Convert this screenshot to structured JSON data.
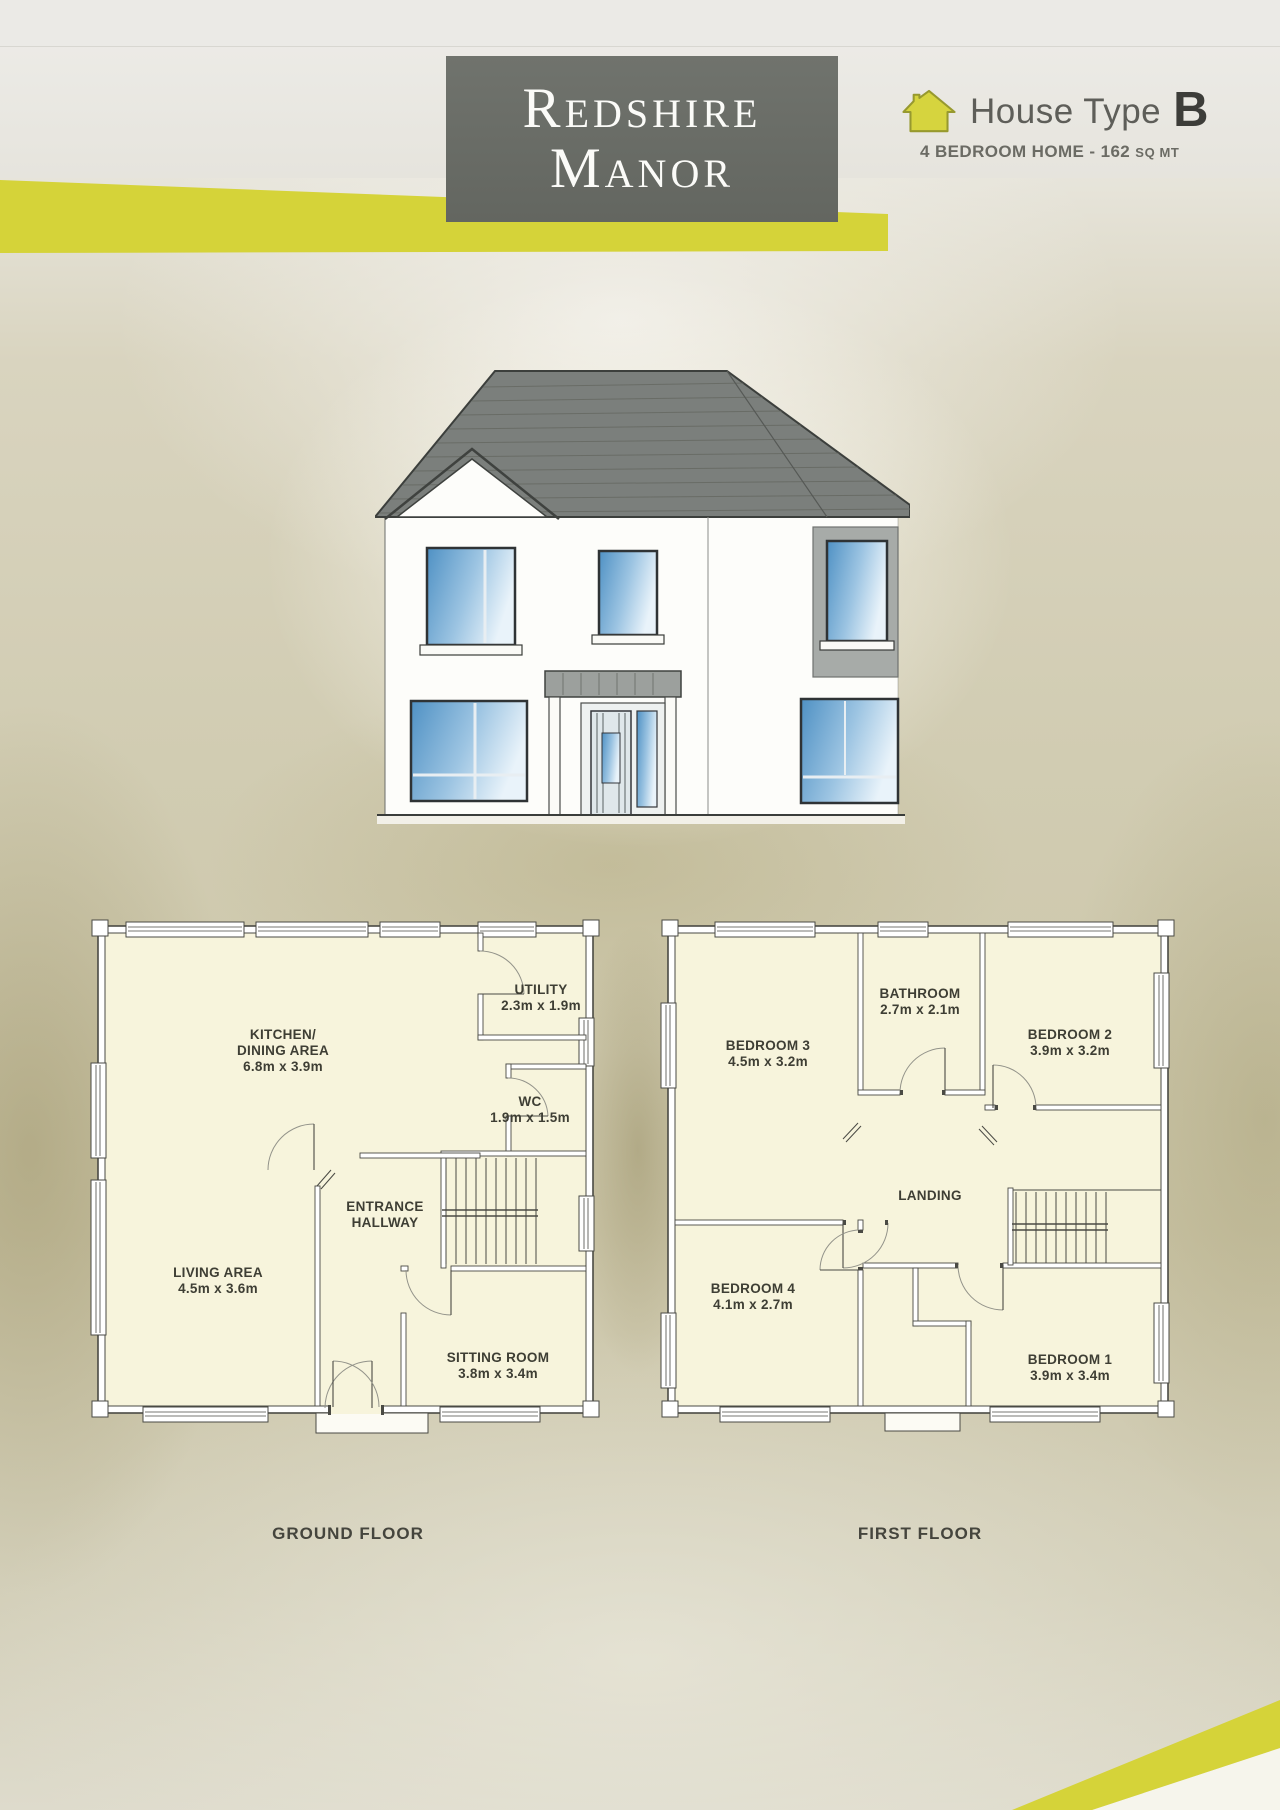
{
  "header": {
    "title_line1": "Redshire",
    "title_line2": "Manor",
    "house_type_label": "House Type",
    "house_type_value": "B",
    "subtitle_prefix": "4 BEDROOM HOME",
    "subtitle_sep": "-",
    "subtitle_value": "162",
    "subtitle_unit": "SQ MT"
  },
  "colors": {
    "accent_yellow": "#d5d339",
    "header_box_gray": "#6a6d67",
    "roof_gray": "#7b7f7c",
    "window_blue": "#4f91c4",
    "plan_room_fill": "#f7f4dc"
  },
  "floors": {
    "ground": {
      "caption": "GROUND FLOOR",
      "rooms": {
        "kitchen": {
          "name1": "KITCHEN/",
          "name2": "DINING AREA",
          "dims": "6.8m x 3.9m"
        },
        "utility": {
          "name": "UTILITY",
          "dims": "2.3m x 1.9m"
        },
        "wc": {
          "name": "WC",
          "dims": "1.9m x 1.5m"
        },
        "hallway": {
          "name1": "ENTRANCE",
          "name2": "HALLWAY"
        },
        "living": {
          "name": "LIVING AREA",
          "dims": "4.5m x 3.6m"
        },
        "sitting": {
          "name": "SITTING ROOM",
          "dims": "3.8m x 3.4m"
        }
      }
    },
    "first": {
      "caption": "FIRST FLOOR",
      "rooms": {
        "bedroom3": {
          "name": "BEDROOM 3",
          "dims": "4.5m x 3.2m"
        },
        "bathroom": {
          "name": "BATHROOM",
          "dims": "2.7m x 2.1m"
        },
        "bedroom2": {
          "name": "BEDROOM 2",
          "dims": "3.9m x 3.2m"
        },
        "landing": {
          "name": "LANDING"
        },
        "bedroom4": {
          "name": "BEDROOM 4",
          "dims": "4.1m x 2.7m"
        },
        "bedroom1": {
          "name": "BEDROOM 1",
          "dims": "3.9m x 3.4m"
        }
      }
    }
  }
}
